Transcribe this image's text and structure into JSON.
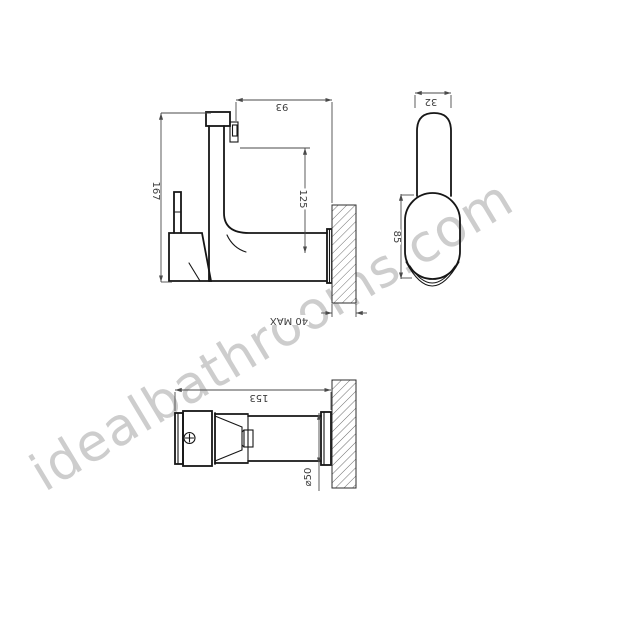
{
  "watermark": {
    "text": "idealbathrooms.com",
    "color": "#cbcbcb"
  },
  "drawing": {
    "background": "#ffffff",
    "outline_color": "#161616",
    "dimension_color": "#4a4a4a",
    "hatch_color": "#6e6e6e",
    "dimensions": {
      "side_view": {
        "overall_height": "167",
        "spout_projection": "93",
        "top_to_spout_axis": "125",
        "max_wall_thickness": "40 MAX"
      },
      "front_view": {
        "handle_width": "32",
        "body_height": "85"
      },
      "plan_view": {
        "overall_length": "153",
        "wall_flange_diameter": "⌀50"
      }
    }
  }
}
